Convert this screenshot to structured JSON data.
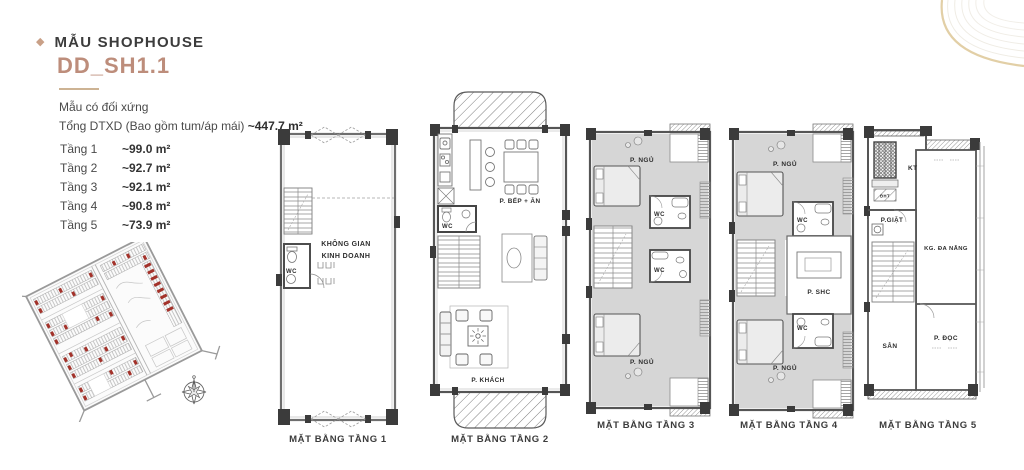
{
  "header": {
    "icon": "◆",
    "category": "MẪU SHOPHOUSE",
    "model_code": "DD_SH1.1",
    "subtitle": "Mẫu có đối xứng",
    "total_label": "Tổng DTXD (Bao gồm tum/áp mái)",
    "total_value": "~447.7 m²"
  },
  "floor_areas": [
    {
      "label": "Tầng 1",
      "value": "~99.0 m²"
    },
    {
      "label": "Tầng 2",
      "value": "~92.7 m²"
    },
    {
      "label": "Tầng 3",
      "value": "~92.1 m²"
    },
    {
      "label": "Tầng 4",
      "value": "~90.8 m²"
    },
    {
      "label": "Tầng 5",
      "value": "~73.9 m²"
    }
  ],
  "plans": [
    {
      "caption": "MẶT BẰNG TẦNG 1",
      "labels": {
        "room1": "KHÔNG GIAN",
        "room1b": "KINH DOANH",
        "wc": "WC"
      }
    },
    {
      "caption": "MẶT BẰNG TẦNG 2",
      "labels": {
        "kitchen": "P. BẾP + ĂN",
        "wc": "WC",
        "living": "P. KHÁCH"
      }
    },
    {
      "caption": "MẶT BẰNG TẦNG 3",
      "labels": {
        "bed_top": "P. NGỦ",
        "wc_top": "WC",
        "wc_bottom": "WC",
        "bed_bottom": "P. NGỦ"
      }
    },
    {
      "caption": "MẶT BẰNG TẦNG 4",
      "labels": {
        "bed_top": "P. NGỦ",
        "wc_top": "WC",
        "shc": "P. SHC",
        "wc_bottom": "WC",
        "bed_bottom": "P. NGỦ"
      }
    },
    {
      "caption": "MẶT BẰNG TẦNG 5",
      "labels": {
        "kt": "KT",
        "dht": "ĐHT",
        "laundry": "P.GIẶT",
        "multi": "KG. ĐA NĂNG",
        "yard": "SÂN",
        "reading": "P. ĐỌC"
      }
    }
  ],
  "colors": {
    "accent": "#bd8d7b",
    "diamond": "#c9a087",
    "text": "#3d3d3d",
    "wall": "#4f4f4f",
    "room_fill": "#d6d6d6",
    "site_red": "#a3322a",
    "decor_tan": "#e2cfa6"
  }
}
